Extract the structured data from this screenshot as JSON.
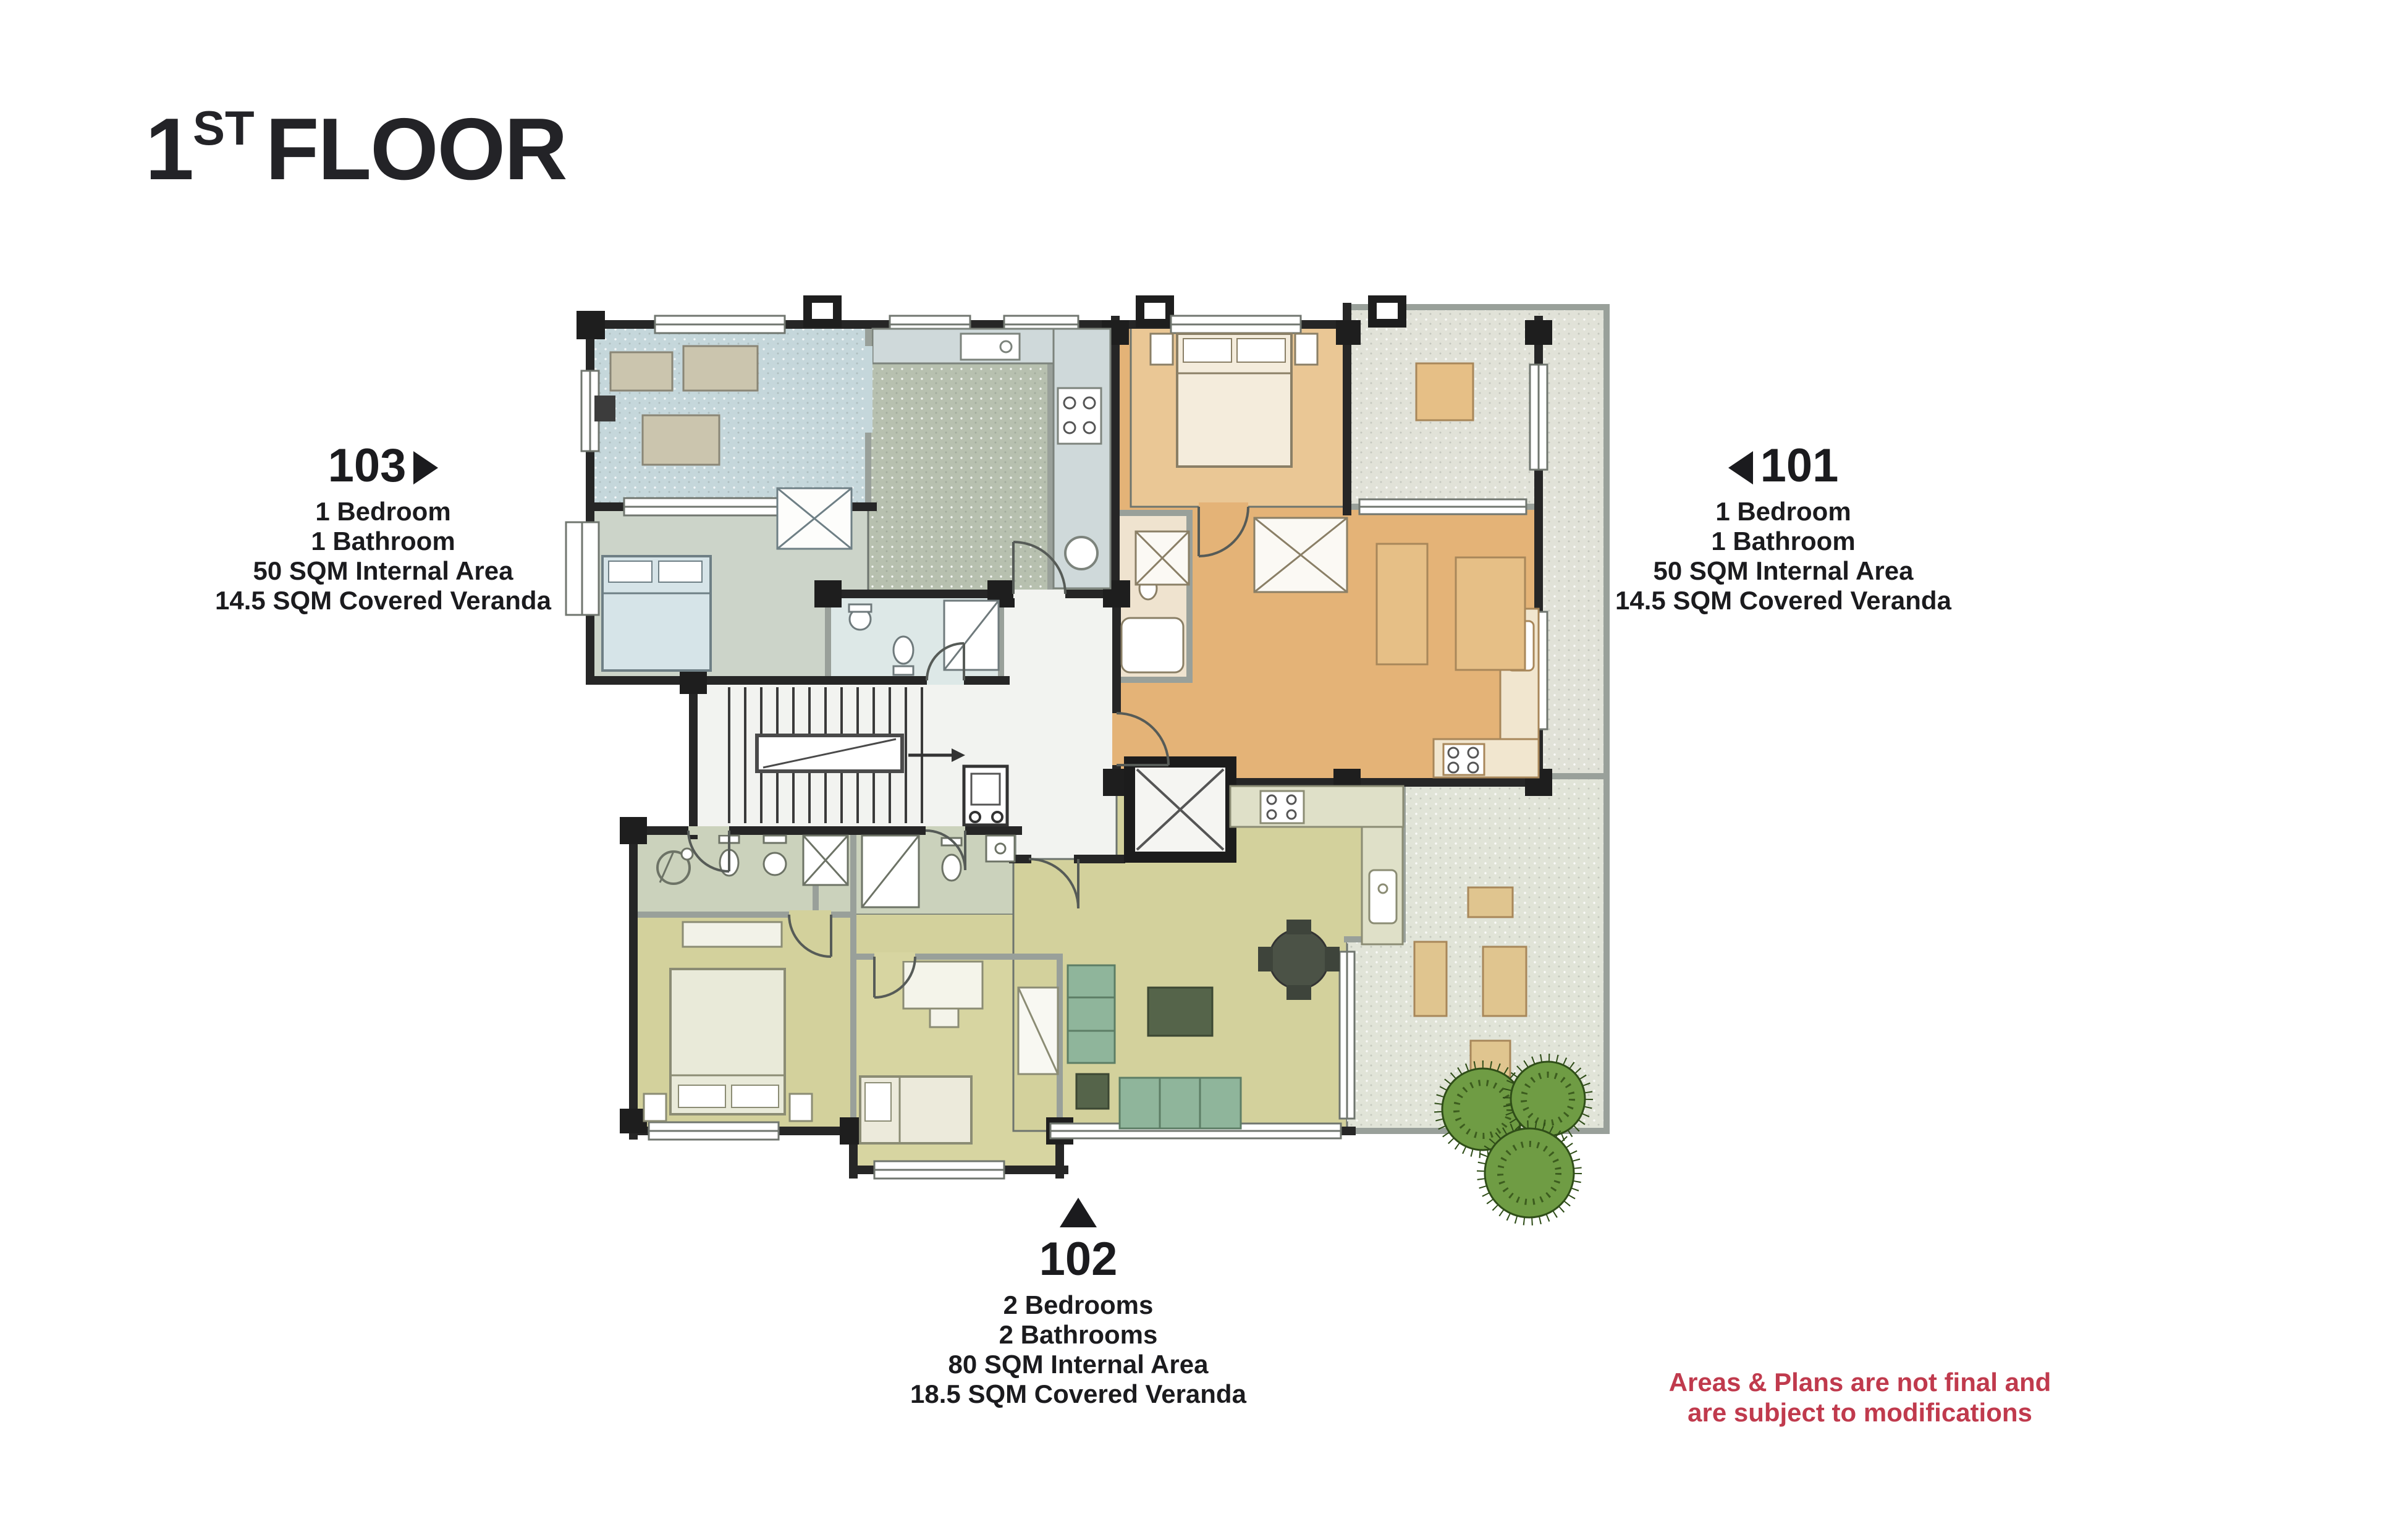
{
  "page": {
    "title": {
      "number": "1",
      "ordinal": "ST",
      "word": "FLOOR"
    }
  },
  "apartments": [
    {
      "id": "103",
      "direction": "right",
      "lines": [
        "1 Bedroom",
        "1 Bathroom",
        "50 SQM Internal Area",
        "14.5 SQM Covered Veranda"
      ]
    },
    {
      "id": "101",
      "direction": "left",
      "lines": [
        "1 Bedroom",
        "1 Bathroom",
        "50 SQM Internal Area",
        "14.5 SQM Covered Veranda"
      ]
    },
    {
      "id": "102",
      "direction": "up",
      "lines": [
        "2 Bedrooms",
        "2 Bathrooms",
        "80 SQM Internal Area",
        "18.5 SQM Covered Veranda"
      ]
    }
  ],
  "disclaimer": {
    "lines": [
      "Areas & Plans are not final and",
      "are subject to modifications"
    ],
    "color": "#c03a4d"
  },
  "plan": {
    "colors": {
      "apartment_103_veranda": "#c5d7db",
      "apartment_103_living": "#b7c0af",
      "apartment_101": "#e4b377",
      "apartment_102": "#d3d19c",
      "veranda_open": "#e1e2d8",
      "walls": "#262626",
      "sofa_green": "#8fb59b",
      "plants": "#6f9c44"
    }
  }
}
